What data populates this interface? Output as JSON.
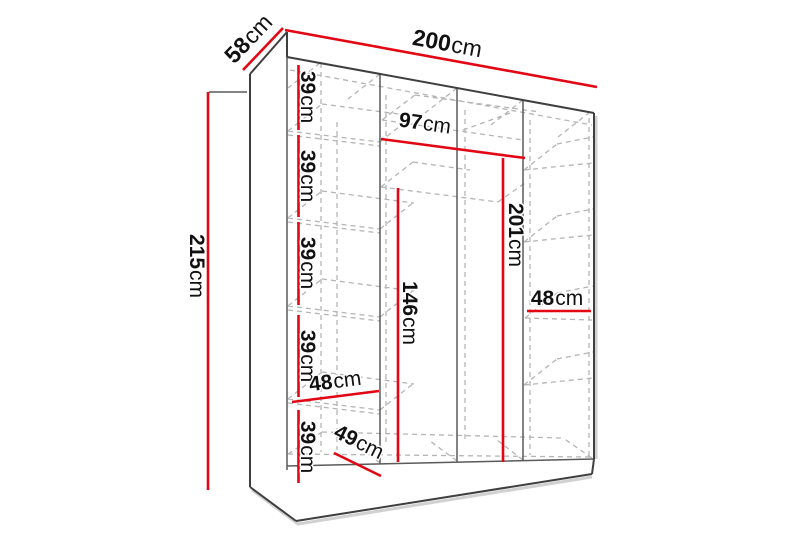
{
  "diagram": {
    "type": "wardrobe-dimension-diagram",
    "unit": "cm",
    "colors": {
      "dimension_line": "#e30613",
      "outline": "#3f3f3f",
      "inner_lines": "#5a5a5a",
      "hidden_dashed": "#b5b5b5",
      "label_text": "#111111",
      "background": "#ffffff"
    }
  },
  "dims": {
    "width": {
      "num": "200",
      "unit": "cm"
    },
    "depth": {
      "num": "58",
      "unit": "cm"
    },
    "height": {
      "num": "215",
      "unit": "cm"
    },
    "shelf_gap_1": {
      "num": "39",
      "unit": "cm"
    },
    "shelf_gap_2": {
      "num": "39",
      "unit": "cm"
    },
    "shelf_gap_3": {
      "num": "39",
      "unit": "cm"
    },
    "shelf_gap_4": {
      "num": "39",
      "unit": "cm"
    },
    "shelf_gap_5": {
      "num": "39",
      "unit": "cm"
    },
    "left_section_width": {
      "num": "48",
      "unit": "cm"
    },
    "base_depth": {
      "num": "49",
      "unit": "cm"
    },
    "middle_section_width": {
      "num": "97",
      "unit": "cm"
    },
    "middle_section_height": {
      "num": "201",
      "unit": "cm"
    },
    "hanging_height": {
      "num": "146",
      "unit": "cm"
    },
    "right_section_width": {
      "num": "48",
      "unit": "cm"
    }
  }
}
